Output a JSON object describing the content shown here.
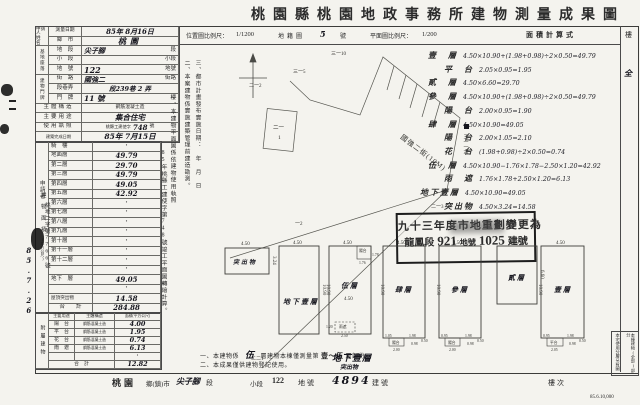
{
  "title": "桃園縣桃園地政事務所建物測量成果圖",
  "header": {
    "loc_scale_label": "位置圖比例尺：",
    "loc_scale": "1/1200",
    "cadastral_label": "地籍圖",
    "cadastral_no": "5",
    "cadastral_unit": "號",
    "plan_scale_label": "平面圖比例尺：",
    "plan_scale": "1/200",
    "calc_title": "面積計算式",
    "floor_col": "樓",
    "floor_col_value": "全"
  },
  "applicant": {
    "label": "申請人",
    "name_label": "姓　名",
    "received_label": "申請者",
    "received_no": "桃地二字第7766號",
    "received_date": "85.7.26"
  },
  "form": {
    "survey_date_label": "測量日期",
    "survey_date": "85年 8月16日",
    "site_group": "基地座落",
    "rows": [
      {
        "label": "鄉　市",
        "value": "桃園",
        "unit": ""
      },
      {
        "label": "地　段",
        "value": "尖子腳",
        "unit": "段"
      },
      {
        "label": "小　段",
        "value": "",
        "unit": "小段"
      },
      {
        "label": "地　號",
        "value": "122",
        "unit": "地號"
      }
    ],
    "door_group": "建物門牌",
    "door_rows": [
      {
        "label": "街　路",
        "value": "國強二",
        "unit": "街路"
      },
      {
        "label": "段巷弄",
        "value": "段239巷 2 弄",
        "unit": ""
      },
      {
        "label": "門　牌",
        "value": "11 號",
        "unit": "樓"
      }
    ],
    "structure_label": "主體構造",
    "structure": "鋼筋混凝土造",
    "usage_label": "主要用途",
    "usage": "集合住宅",
    "license_label": "使用執照",
    "license_prefix": "桃縣工建使字",
    "license_no": "748",
    "license_unit": "號",
    "complete_label": "建築完成日期",
    "complete_date": "85年 7月15日"
  },
  "floor_table": {
    "group": "建物面積",
    "group_sub": "(平方公尺)",
    "rows": [
      {
        "label": "騎　樓",
        "value": "・"
      },
      {
        "label": "地面層",
        "value": "49.79"
      },
      {
        "label": "第二層",
        "value": "29.70"
      },
      {
        "label": "第三層",
        "value": "49.79"
      },
      {
        "label": "第四層",
        "value": "49.05"
      },
      {
        "label": "第五層",
        "value": "42.92"
      },
      {
        "label": "第六層",
        "value": "・"
      },
      {
        "label": "第七層",
        "value": "・"
      },
      {
        "label": "第八層",
        "value": "・"
      },
      {
        "label": "第九層",
        "value": "・"
      },
      {
        "label": "第十層",
        "value": "・"
      },
      {
        "label": "第十一層",
        "value": "・"
      },
      {
        "label": "第十二層",
        "value": "・"
      },
      {
        "label": "",
        "value": "・"
      },
      {
        "label": "地下　層",
        "value": "49.05"
      },
      {
        "label": "",
        "value": "・"
      },
      {
        "label": "屋頂突出物",
        "value": "14.58"
      },
      {
        "label": "合　　計",
        "value": "284.88"
      }
    ]
  },
  "annex_table": {
    "group": "附屬建物",
    "headers": [
      "主要用途",
      "主體構造",
      "面積(平方公尺)"
    ],
    "rows": [
      {
        "use": "陽　台",
        "structure": "鋼筋混凝土造",
        "area": "4.00"
      },
      {
        "use": "平　台",
        "structure": "鋼筋混凝土造",
        "area": "1.95"
      },
      {
        "use": "花　台",
        "structure": "鋼筋混凝土造",
        "area": "0.74"
      },
      {
        "use": "雨　遮",
        "structure": "鋼筋混凝土造",
        "area": "6.13"
      },
      {
        "use": "",
        "structure": "",
        "area": "・"
      },
      {
        "use": "合　計",
        "structure": "",
        "area": "12.82"
      }
    ]
  },
  "side_notes": [
    "一、本建物平面圖係依建物使用執照",
    "85年桃縣工建使字第748號竣工平面圖轉繪計算。",
    "二、本案建物係實施建築管理前建造勘測。",
    "三、都市計畫發布實施日期：　年　月　日"
  ],
  "map": {
    "street": "國強二街(10M)",
    "labels": [
      "三一10",
      "三一5",
      "二一2",
      "二一",
      "1",
      "一2",
      "二一3",
      "二二1",
      "三一一六"
    ]
  },
  "calc": {
    "lines": [
      {
        "label": "壹　層",
        "formula": "4.50×10.90+(1.98+0.98)÷2×0.50=49.79"
      },
      {
        "label": "平　台",
        "formula": "2.05×0.95=1.95"
      },
      {
        "label": "貳　層",
        "formula": "4.50×6.60=29.70"
      },
      {
        "label": "參　層",
        "formula": "4.50×10.90+(1.98+0.98)÷2×0.50=49.79"
      },
      {
        "label": "陽　台",
        "formula": "2.00×0.95=1.90"
      },
      {
        "label": "肆　層",
        "formula": "4.50×10.90=49.05"
      },
      {
        "label": "陽　台",
        "formula": "2.00×1.05=2.10"
      },
      {
        "label": "花　台",
        "formula": "(1.98+0.98)÷2×0.50=0.74"
      },
      {
        "label": "伍　層",
        "formula": "4.50×10.90−1.76×1.78−2.50×1.20=42.92"
      },
      {
        "label": "雨　遮",
        "formula": "1.76×1.78+2.50×1.20=6.13"
      },
      {
        "label": "地下壹層",
        "formula": "4.50×10.90=49.05"
      },
      {
        "label": "突出物",
        "formula": "4.50×3.24=14.58"
      }
    ]
  },
  "stamp": {
    "line1": "九十三年度市地重劃變更為",
    "seg": "龍鳳段",
    "no": "921",
    "unit": "地號",
    "bno": "1025",
    "bunit": "建號"
  },
  "plans": [
    {
      "label": "突出物",
      "top": "4.50",
      "side": "3.24"
    },
    {
      "label": "地下壹層",
      "top": "4.50",
      "side": "10.90"
    },
    {
      "label": "伍層",
      "top": "4.50",
      "side": "10.90",
      "inner": "4.50",
      "b_label": "陽台",
      "b_w": "1.76",
      "b_h": "1.78",
      "c_label": "雨遮",
      "c_w": "2.50",
      "c_h": "1.20"
    },
    {
      "label": "肆層",
      "top": "4.50",
      "side": "10.90",
      "b_label": "陽台",
      "b_w": "2.00",
      "b_h": "1.05",
      "n1": "1.98",
      "n2": "0.98",
      "n3": "0.50"
    },
    {
      "label": "參層",
      "top": "4.50",
      "side": "10.90",
      "b_label": "陽台",
      "b_w": "2.00",
      "b_h": "0.95",
      "n1": "1.98",
      "n2": "0.98",
      "n3": "0.50"
    },
    {
      "label": "貳層",
      "top": "4.50",
      "side": "6.60"
    },
    {
      "label": "壹層",
      "top": "4.50",
      "side": "10.90",
      "b_label": "平台",
      "b_w": "2.05",
      "b_h": "0.95",
      "n1": "1.98",
      "n2": "0.98",
      "n3": "0.50"
    }
  ],
  "bottom_notes": {
    "n1_pre": "一、本建物係",
    "n1_floors": "伍",
    "n1_mid": "層建物本棟僅測量第",
    "n1_range": "壹～伍",
    "n1_suf": "層部份。",
    "n2": "二、本成果僅供建物登記使用。",
    "hand1": "地下壹層",
    "hand2": "突出物"
  },
  "legend": [
    "本棟建物(全部)部分",
    "本宅使用分層另有圖"
  ],
  "footer": {
    "city": "桃園",
    "city_unit": "鄉(鎮)市",
    "section": "尖子腳",
    "section_unit": "段",
    "subsection_unit": "小段",
    "parcel": "122",
    "parcel_unit": "地號",
    "building": "4894",
    "building_unit": "建號",
    "floor_unit": "樓次",
    "print_code": "85.6.10,000"
  }
}
